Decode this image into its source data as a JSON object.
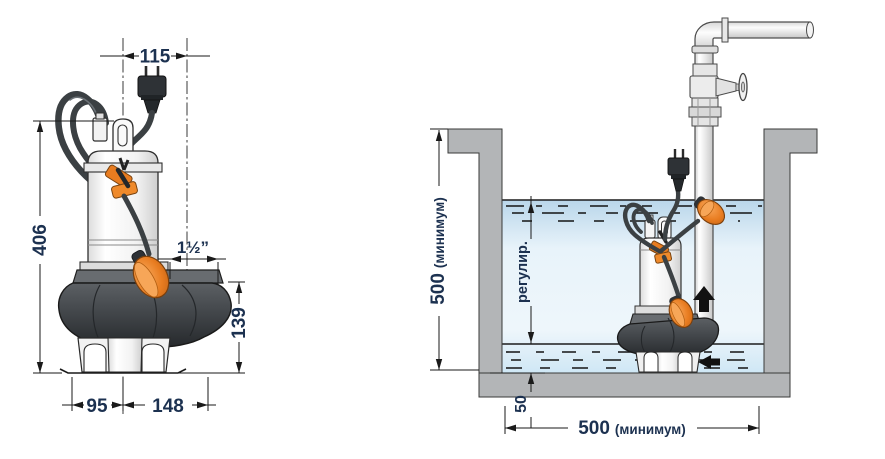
{
  "drawing": {
    "type": "submersible-pump-technical-diagram",
    "left_view": {
      "dim_plug_offset": "115",
      "dim_overall_height": "406",
      "dim_discharge_port": "1½”",
      "dim_volute_height": "139",
      "dim_foot_to_axis": "95",
      "dim_axis_to_volute_edge": "148"
    },
    "right_view": {
      "dim_pit_depth": {
        "value": "500",
        "qualifier": "(минимум)"
      },
      "dim_level_range_label": "регулир.",
      "dim_bottom_clearance": "50",
      "dim_pit_width": {
        "value": "500",
        "qualifier": "(минимум)"
      }
    },
    "colors": {
      "dimension_text": "#1c3150",
      "line": "#1a1a1a",
      "float_orange": "#e87c20",
      "volute_dark": "#3a3e42",
      "water_blue": "#cfe6f6",
      "pit_wall_grey": "#b3b5b7",
      "flow_arrow": "#111111"
    }
  }
}
